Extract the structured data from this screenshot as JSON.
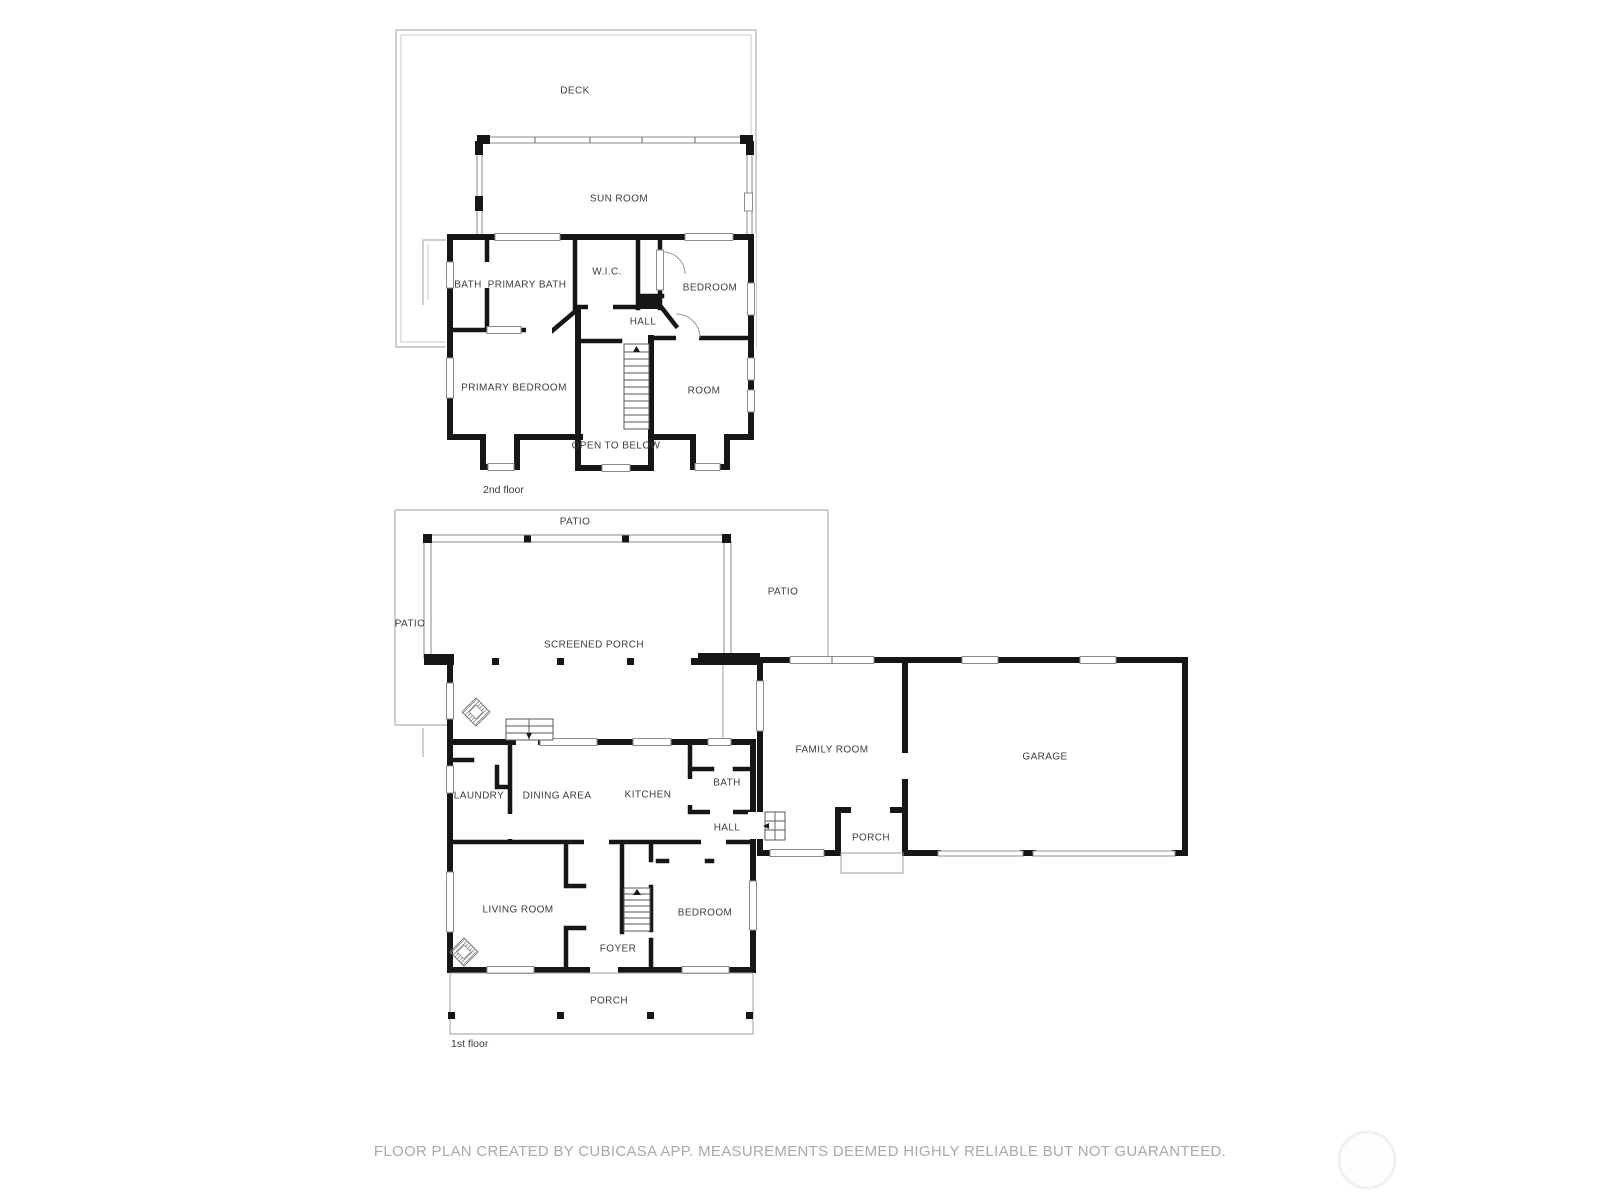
{
  "meta": {
    "footer": "FLOOR PLAN CREATED BY CUBICASA APP. MEASUREMENTS DEEMED HIGHLY RELIABLE BUT NOT GUARANTEED."
  },
  "colors": {
    "wall": "#161616",
    "thin_line": "#9f9f9f",
    "label_text": "#3d3d3d",
    "footer_text": "#a9a9a9"
  },
  "floors": [
    {
      "name": "2nd floor",
      "rooms": [
        {
          "label": "DECK"
        },
        {
          "label": "SUN ROOM"
        },
        {
          "label": "BATH"
        },
        {
          "label": "PRIMARY BATH"
        },
        {
          "label": "W.I.C."
        },
        {
          "label": "BEDROOM"
        },
        {
          "label": "HALL"
        },
        {
          "label": "PRIMARY BEDROOM"
        },
        {
          "label": "ROOM"
        },
        {
          "label": "OPEN TO BELOW"
        }
      ]
    },
    {
      "name": "1st floor",
      "rooms": [
        {
          "label": "PATIO"
        },
        {
          "label": "PATIO"
        },
        {
          "label": "PATIO"
        },
        {
          "label": "SCREENED PORCH"
        },
        {
          "label": "LAUNDRY"
        },
        {
          "label": "DINING AREA"
        },
        {
          "label": "KITCHEN"
        },
        {
          "label": "BATH"
        },
        {
          "label": "HALL"
        },
        {
          "label": "FAMILY ROOM"
        },
        {
          "label": "GARAGE"
        },
        {
          "label": "PORCH"
        },
        {
          "label": "LIVING ROOM"
        },
        {
          "label": "FOYER"
        },
        {
          "label": "BEDROOM"
        },
        {
          "label": "PORCH"
        }
      ]
    }
  ]
}
